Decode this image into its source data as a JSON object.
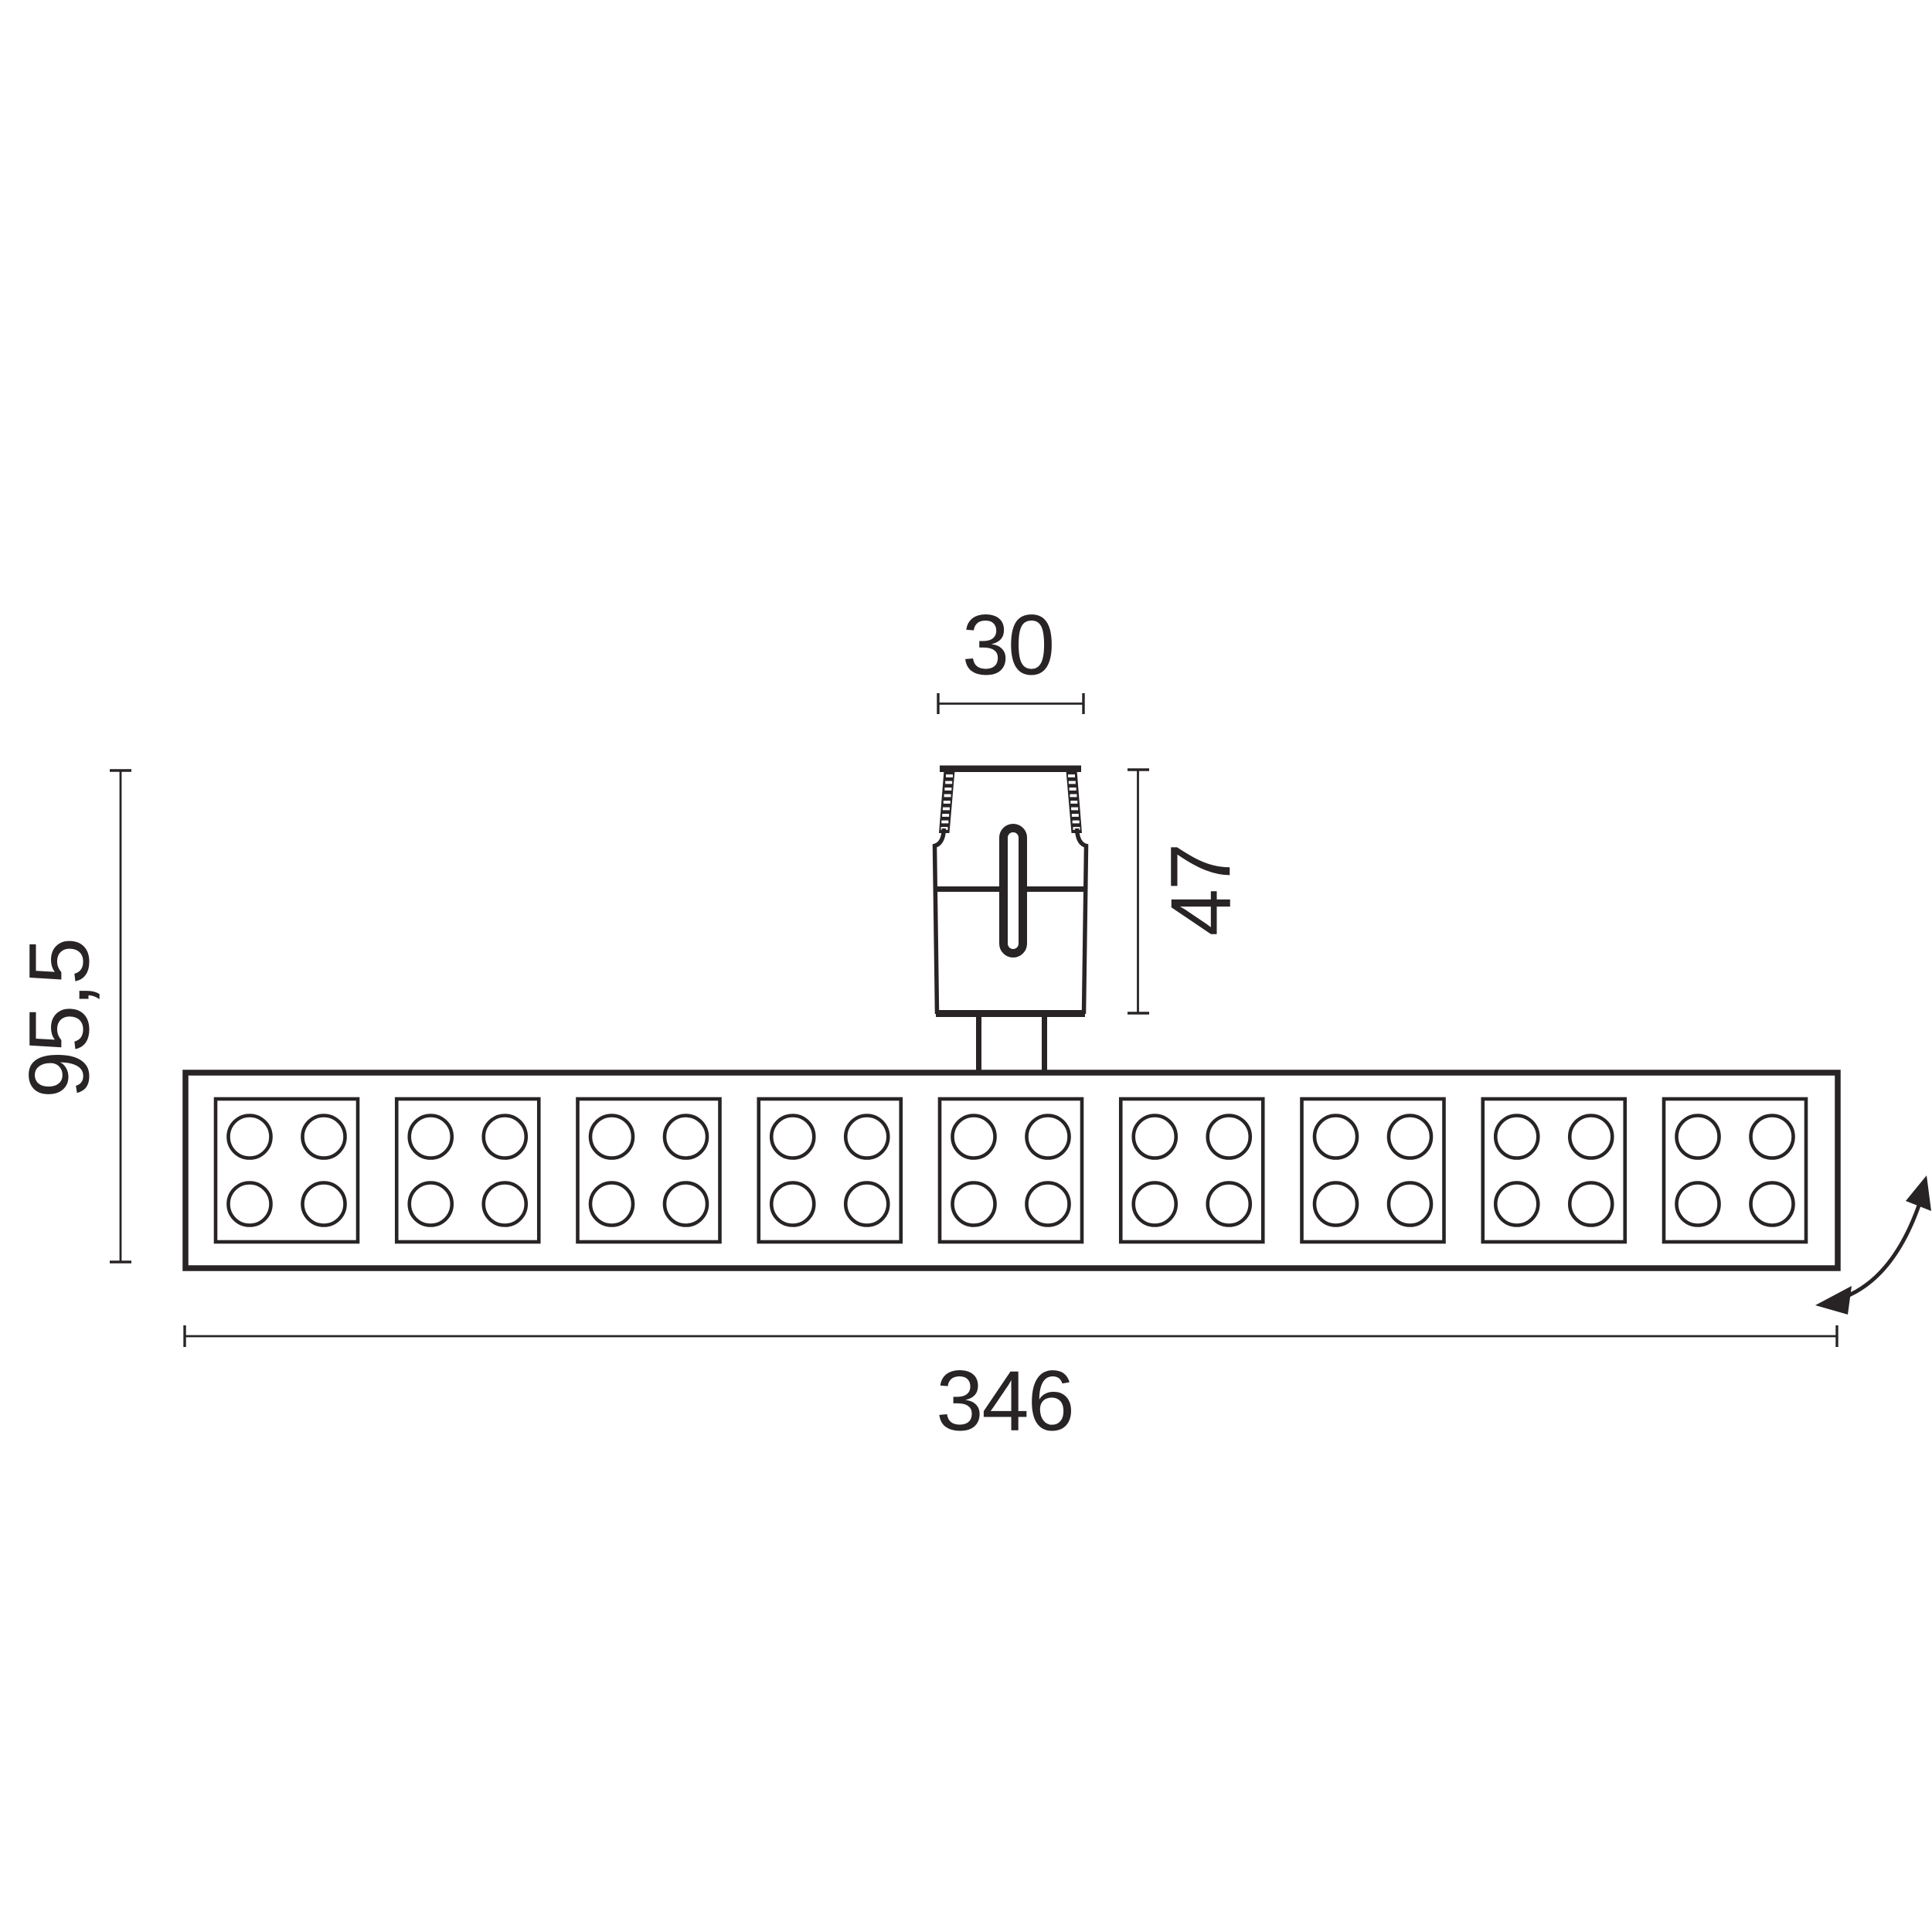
{
  "drawing": {
    "title": "track light fixture dimension drawing",
    "view": "side elevation",
    "ink_color": "#282425",
    "background_color": "#ffffff",
    "dimensions": {
      "adapter_width": "30",
      "adapter_height": "47",
      "overall_height": "95,5",
      "overall_width": "346"
    },
    "modules": {
      "count": 9,
      "leds_per_module": 4
    },
    "icons": {
      "rotation_arrow": "curved-double-arrow"
    }
  }
}
